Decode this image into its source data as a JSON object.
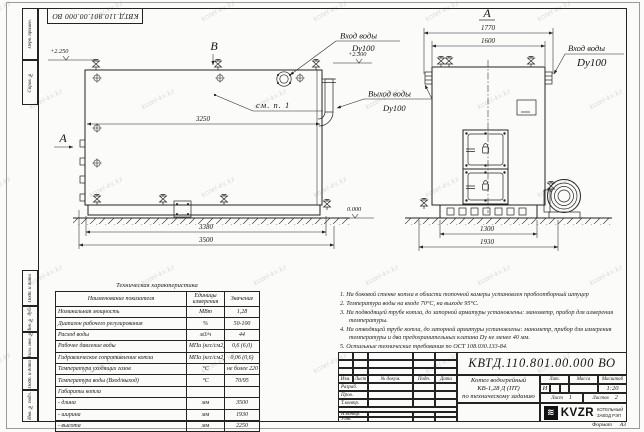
{
  "sheet": {
    "stamp": "КВТД.110.801.00.000 ВО",
    "watermark": "kotel-kv.kz",
    "format_label": "Формат",
    "format_value": "А3"
  },
  "frame": {
    "strip_labels": [
      "Перв. примен.",
      "Справ. №",
      "Подп. и дата",
      "Инв. № дубл.",
      "Взам. инв. №",
      "Подп. и дата",
      "Инв. № подл."
    ]
  },
  "views": {
    "left": {
      "marker_view": "А",
      "marker_top": "В",
      "dim_width": "3250",
      "dim_base": "3380",
      "dim_total": "3500",
      "level_top": "+2.250",
      "level_pipe": "+2.300",
      "level_zero": "0.000",
      "note_ref": "см. п. 1"
    },
    "right": {
      "title": "А",
      "dim_flanges": "1770",
      "dim_width": "1600",
      "dim_base": "1300",
      "dim_total": "1930"
    }
  },
  "labels": {
    "water_in_left": {
      "l1": "Вход воды",
      "l2": "Dy100"
    },
    "water_out": {
      "l1": "Выход воды",
      "l2": "Dy100"
    },
    "water_in_right": {
      "l1": "Вход воды",
      "l2": "Dy100"
    }
  },
  "notes": {
    "items": [
      "1.  На боковой стенке котла в области топочной камеры установлен пробоотборный штуцер",
      "2.  Температура воды на входе 70°С, на выходе 95°С.",
      "3.  На подводящей трубе котла, до запорной арматуры установлены: манометр, прибор для измерения температуры.",
      "4.  На отводящей трубе котла, до запорной арматуры установлены: манометр, прибор для измерения температуры и два предохранительных клапана Dy не менее 40 мм.",
      "5.  Остальные технические требования по ОСТ 108.030.133-84."
    ]
  },
  "tech_table": {
    "title": "Техническая характеристика",
    "headers": [
      "Наименование показателя",
      "Единицы измерения",
      "Значение"
    ],
    "rows": [
      {
        "name": "Номинальная мощность",
        "unit": "МВт",
        "value": "1,28"
      },
      {
        "name": "Диапазон рабочего регулирования",
        "unit": "%",
        "value": "50-100"
      },
      {
        "name": "Расход воды",
        "unit": "м3/ч",
        "value": "44"
      },
      {
        "name": "Рабочее давление воды",
        "unit": "МПа (кгс/см2)",
        "value": "0,6 (6,0)"
      },
      {
        "name": "Гидравлическое сопротивление котла",
        "unit": "МПа (кгс/см2)",
        "value": "0,06 (0,6)"
      },
      {
        "name": "Температура уходящих газов",
        "unit": "°С",
        "value": "не более 220"
      },
      {
        "name": "Температура воды (Вход/выход)",
        "unit": "°С",
        "value": "70/95"
      },
      {
        "name": "Габариты котла",
        "unit": "",
        "value": ""
      },
      {
        "name": "-  длина",
        "unit": "мм",
        "value": "3500"
      },
      {
        "name": "-  ширина",
        "unit": "мм",
        "value": "1930"
      },
      {
        "name": "-  высота",
        "unit": "мм",
        "value": "2250"
      }
    ]
  },
  "title_block": {
    "doc_number": "КВТД.110.801.00.000 ВО",
    "name_line1": "Котел водогрейный",
    "name_line2": "КВ-1,28 Д (ПТ)",
    "name_line3": "по техническому заданию",
    "rev_headers": [
      "Изм.",
      "Лист",
      "№ докум.",
      "Подп.",
      "Дата"
    ],
    "sign_rows": [
      "Разраб.",
      "Пров.",
      "Т.контр.",
      "Н.контр.",
      "Утв."
    ],
    "lit_label": "Лит.",
    "lit_value": "И",
    "mass_label": "Масса",
    "scale_label": "Масштаб",
    "scale_value": "1:20",
    "sheet_label": "Лист",
    "sheet_value": "1",
    "sheets_label": "Листов",
    "sheets_value": "2",
    "logo_icon": "≋",
    "logo_text": "KVZR",
    "logo_sub1": "КОТЕЛЬНЫЙ",
    "logo_sub2": "ЗАВОД РЭП"
  }
}
